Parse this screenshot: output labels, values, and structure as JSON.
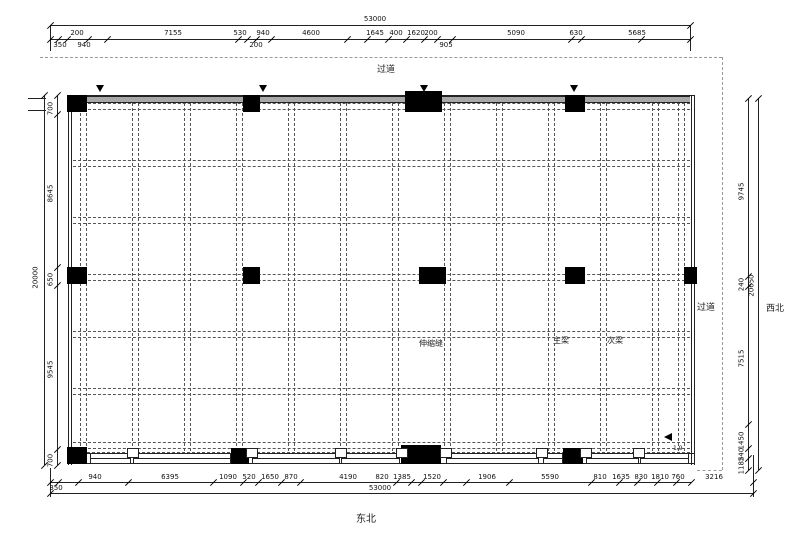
{
  "drawing": {
    "corridor_top": "过道",
    "corridor_right": "过道",
    "compass_right": "西北",
    "compass_bottom": "东北",
    "note_expansion_joint": "伸缩缝",
    "note_main_beam": "主梁",
    "note_secondary_beam": "次梁",
    "note_arrow": "1.9"
  },
  "dimensions": {
    "top": {
      "total": "53000",
      "segments": [
        {
          "v": "200",
          "x": 77
        },
        {
          "v": "7155",
          "x": 173
        },
        {
          "v": "530",
          "x": 240
        },
        {
          "v": "940",
          "x": 263
        },
        {
          "v": "4600",
          "x": 311
        },
        {
          "v": "1645",
          "x": 375
        },
        {
          "v": "400",
          "x": 396
        },
        {
          "v": "1620",
          "x": 416
        },
        {
          "v": "200",
          "x": 431
        },
        {
          "v": "5090",
          "x": 516
        },
        {
          "v": "630",
          "x": 576
        },
        {
          "v": "5685",
          "x": 637
        }
      ],
      "sub": [
        {
          "v": "350",
          "x": 60
        },
        {
          "v": "940",
          "x": 84
        },
        {
          "v": "200",
          "x": 256
        },
        {
          "v": "905",
          "x": 446
        }
      ]
    },
    "bottom": {
      "total": "53000",
      "segments": [
        {
          "v": "940",
          "x": 95
        },
        {
          "v": "6395",
          "x": 170
        },
        {
          "v": "1090",
          "x": 228
        },
        {
          "v": "520",
          "x": 249
        },
        {
          "v": "1650",
          "x": 270
        },
        {
          "v": "870",
          "x": 291
        },
        {
          "v": "4190",
          "x": 348
        },
        {
          "v": "820",
          "x": 382
        },
        {
          "v": "1385",
          "x": 402
        },
        {
          "v": "1520",
          "x": 432
        },
        {
          "v": "1906",
          "x": 487
        },
        {
          "v": "5590",
          "x": 550
        },
        {
          "v": "810",
          "x": 600
        },
        {
          "v": "1635",
          "x": 621
        },
        {
          "v": "830",
          "x": 641
        },
        {
          "v": "1810",
          "x": 660
        },
        {
          "v": "760",
          "x": 678
        },
        {
          "v": "3216",
          "x": 714
        }
      ],
      "sub": [
        {
          "v": "350",
          "x": 56
        }
      ]
    },
    "left": {
      "total": "20000",
      "segments": [
        {
          "v": "700",
          "y": 105
        },
        {
          "v": "8645",
          "y": 190
        },
        {
          "v": "650",
          "y": 276
        },
        {
          "v": "9545",
          "y": 366
        },
        {
          "v": "700",
          "y": 457
        }
      ]
    },
    "right": {
      "total": "20650",
      "segments": [
        {
          "v": "9745",
          "y": 188
        },
        {
          "v": "240",
          "y": 281
        },
        {
          "v": "7515",
          "y": 355
        },
        {
          "v": "1450",
          "y": 437
        },
        {
          "v": "240",
          "y": 451
        },
        {
          "v": "1185",
          "y": 462
        }
      ]
    }
  },
  "grid": {
    "vertical_x": [
      83,
      135,
      187,
      239,
      291,
      343,
      395,
      447,
      499,
      551,
      603,
      655,
      681
    ],
    "horizontal_y": [
      106,
      163,
      220,
      277,
      334,
      391,
      445
    ]
  },
  "columns": [
    [
      67,
      95,
      20,
      17
    ],
    [
      243,
      95,
      17,
      17
    ],
    [
      405,
      91,
      37,
      21
    ],
    [
      565,
      95,
      20,
      17
    ],
    [
      67,
      267,
      20,
      17
    ],
    [
      243,
      267,
      17,
      17
    ],
    [
      419,
      267,
      27,
      17
    ],
    [
      565,
      267,
      20,
      17
    ],
    [
      684,
      267,
      13,
      17
    ],
    [
      67,
      447,
      20,
      17
    ],
    [
      231,
      448,
      18,
      16
    ],
    [
      401,
      445,
      40,
      19
    ],
    [
      563,
      448,
      20,
      16
    ]
  ],
  "windows": [
    [
      90,
      39
    ],
    [
      133,
      96
    ],
    [
      252,
      86
    ],
    [
      341,
      57
    ],
    [
      446,
      91
    ],
    [
      543,
      18
    ],
    [
      586,
      51
    ],
    [
      640,
      47
    ]
  ],
  "tabs": [
    127,
    246,
    335,
    396,
    440,
    536,
    580,
    633
  ],
  "arrows_top_x": [
    100,
    263,
    424,
    574
  ],
  "colors": {
    "line": "#222222",
    "beam_dash": "#555555",
    "site_dash": "#9a9a9a",
    "column": "#000000",
    "wall": "#a8a8a8"
  }
}
